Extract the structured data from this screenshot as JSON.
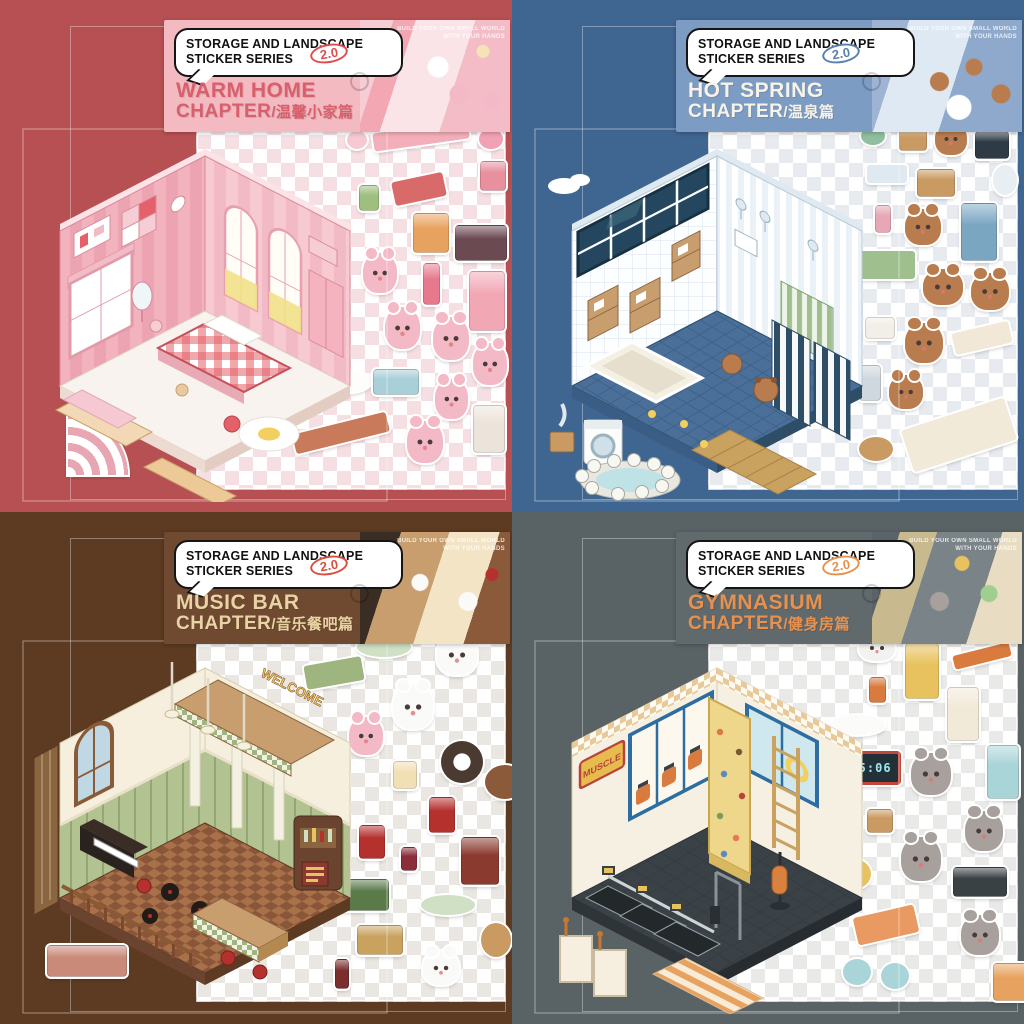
{
  "series": {
    "label_line1": "STORAGE AND LANDSCAPE",
    "label_line2": "STICKER SERIES",
    "version": "2.0",
    "tagline_line1": "BUILD YOUR OWN SMALL WORLD",
    "tagline_line2": "WITH YOUR HANDS"
  },
  "panels": [
    {
      "id": "warm-home",
      "title_line1": "WARM HOME",
      "title_line2": "CHAPTER",
      "title_cn": "/温馨小家篇",
      "colors": {
        "background": "#b75052",
        "header": "#f3bac2",
        "title": "#d95f6c",
        "badge": "#e04b52",
        "wall": "#f2b3bf",
        "floor": "#f8f3ee",
        "character": "#f4b9c6",
        "checker": "#f6dfe3"
      },
      "stickers": [
        {
          "name": "bunting-shelf-sticker",
          "type": "flat",
          "color": "#f2aeb9",
          "x": 176,
          "y": 6,
          "w": 96,
          "h": 18,
          "r": -8
        },
        {
          "name": "pink-donut-sticker",
          "type": "round",
          "color": "#f6c9d2",
          "x": 150,
          "y": 10,
          "w": 20,
          "h": 18
        },
        {
          "name": "heart-cushion-sticker",
          "type": "round",
          "color": "#f2a0b4",
          "x": 282,
          "y": 8,
          "w": 24,
          "h": 20
        },
        {
          "name": "wall-art-sticker",
          "type": "box",
          "color": "#e8909e",
          "x": 283,
          "y": 40,
          "w": 24,
          "h": 28
        },
        {
          "name": "red-desk-sticker",
          "type": "flat",
          "color": "#d96a6a",
          "x": 196,
          "y": 56,
          "w": 52,
          "h": 24,
          "r": -12
        },
        {
          "name": "potted-plant-sticker",
          "type": "box",
          "color": "#9fbf7f",
          "x": 162,
          "y": 64,
          "w": 18,
          "h": 24
        },
        {
          "name": "drawer-unit-sticker",
          "type": "box",
          "color": "#e8a25f",
          "x": 216,
          "y": 92,
          "w": 34,
          "h": 38
        },
        {
          "name": "tv-console-sticker",
          "type": "box",
          "color": "#6b4a52",
          "x": 258,
          "y": 104,
          "w": 50,
          "h": 34
        },
        {
          "name": "bunny-reading-sticker",
          "type": "char",
          "color": "#f4b9c6",
          "x": 166,
          "y": 132,
          "w": 34,
          "h": 40
        },
        {
          "name": "floor-lamp-sticker",
          "type": "tallbox",
          "color": "#e8798c",
          "x": 226,
          "y": 142,
          "w": 15,
          "h": 40
        },
        {
          "name": "pink-fridge-sticker",
          "type": "tallbox",
          "color": "#f2a7b5",
          "x": 272,
          "y": 150,
          "w": 34,
          "h": 58
        },
        {
          "name": "bunny-waving-sticker",
          "type": "char",
          "color": "#f4b9c6",
          "x": 188,
          "y": 186,
          "w": 35,
          "h": 42
        },
        {
          "name": "bunny-bow-sticker",
          "type": "char",
          "color": "#f4b9c6",
          "x": 236,
          "y": 196,
          "w": 36,
          "h": 43
        },
        {
          "name": "white-rug-sticker",
          "type": "oval",
          "color": "#fdfdfb",
          "x": 118,
          "y": 250,
          "w": 56,
          "h": 22
        },
        {
          "name": "bunny-broom-sticker",
          "type": "char",
          "color": "#f4b9c6",
          "x": 276,
          "y": 222,
          "w": 34,
          "h": 42
        },
        {
          "name": "storage-box-sticker",
          "type": "box",
          "color": "#a9cfd8",
          "x": 176,
          "y": 248,
          "w": 44,
          "h": 24
        },
        {
          "name": "bunny-sleepy-sticker",
          "type": "char",
          "color": "#f4b9c6",
          "x": 238,
          "y": 258,
          "w": 33,
          "h": 40
        },
        {
          "name": "fireplace-sticker",
          "type": "box",
          "color": "#ece4da",
          "x": 276,
          "y": 284,
          "w": 30,
          "h": 46
        },
        {
          "name": "brick-bench-sticker",
          "type": "flat",
          "color": "#c97a5a",
          "x": 96,
          "y": 302,
          "w": 96,
          "h": 20,
          "r": -14
        },
        {
          "name": "bunny-cake-sticker",
          "type": "char",
          "color": "#f4b9c6",
          "x": 210,
          "y": 300,
          "w": 36,
          "h": 42
        },
        {
          "name": "rainbow-corner-sticker",
          "type": "fan",
          "color": "#e8a5b2",
          "x": -129,
          "y": 294,
          "w": 60,
          "h": 60
        }
      ]
    },
    {
      "id": "hot-spring",
      "title_line1": "HOT SPRING",
      "title_line2": "CHAPTER",
      "title_cn": "/温泉篇",
      "colors": {
        "background": "#3f6591",
        "header": "#7d9cc4",
        "title": "#f7f3e8",
        "badge": "#5a7fae",
        "wall": "#fdfeff",
        "floor": "#4a7099",
        "character": "#b97c4e",
        "checker": "#e7ebef"
      },
      "stickers": [
        {
          "name": "shower-cap-sticker",
          "type": "round",
          "color": "#8fbf9f",
          "x": 152,
          "y": 6,
          "w": 24,
          "h": 18
        },
        {
          "name": "wooden-bucket-sticker",
          "type": "box",
          "color": "#c99a62",
          "x": 190,
          "y": 8,
          "w": 26,
          "h": 20
        },
        {
          "name": "capybara-towel-sticker",
          "type": "char",
          "color": "#b97c4e",
          "x": 226,
          "y": 2,
          "w": 32,
          "h": 32
        },
        {
          "name": "black-tablet-sticker",
          "type": "box",
          "color": "#2e3a46",
          "x": 266,
          "y": 10,
          "w": 32,
          "h": 26
        },
        {
          "name": "hand-mirror-sticker",
          "type": "round",
          "color": "#e8eef2",
          "x": 284,
          "y": 44,
          "w": 24,
          "h": 30
        },
        {
          "name": "towel-rack-sticker",
          "type": "flat",
          "color": "#dfe9f2",
          "x": 158,
          "y": 44,
          "w": 40,
          "h": 18
        },
        {
          "name": "soap-shelf-sticker",
          "type": "box",
          "color": "#c99a62",
          "x": 208,
          "y": 48,
          "w": 36,
          "h": 26
        },
        {
          "name": "shampoo-bottle-sticker",
          "type": "tallbox",
          "color": "#e8a7b5",
          "x": 166,
          "y": 84,
          "w": 14,
          "h": 26
        },
        {
          "name": "capybara-washing-sticker",
          "type": "char",
          "color": "#b97c4e",
          "x": 196,
          "y": 88,
          "w": 36,
          "h": 36
        },
        {
          "name": "blue-cabinet-sticker",
          "type": "tallbox",
          "color": "#7aa6c2",
          "x": 252,
          "y": 82,
          "w": 34,
          "h": 56
        },
        {
          "name": "bath-fence-sticker",
          "type": "flat",
          "color": "#9fbf8f",
          "x": 150,
          "y": 130,
          "w": 56,
          "h": 28
        },
        {
          "name": "capybara-soaking-sticker",
          "type": "char",
          "color": "#b97c4e",
          "x": 214,
          "y": 148,
          "w": 40,
          "h": 36
        },
        {
          "name": "capybara-duck-sticker",
          "type": "char",
          "color": "#b97c4e",
          "x": 262,
          "y": 152,
          "w": 38,
          "h": 37
        },
        {
          "name": "white-stool-sticker",
          "type": "box",
          "color": "#f2efe8",
          "x": 156,
          "y": 196,
          "w": 28,
          "h": 20
        },
        {
          "name": "capybara-shower-sticker",
          "type": "char",
          "color": "#b97c4e",
          "x": 196,
          "y": 202,
          "w": 38,
          "h": 40
        },
        {
          "name": "cream-bench-sticker",
          "type": "flat",
          "color": "#f2e8d8",
          "x": 244,
          "y": 206,
          "w": 58,
          "h": 22,
          "r": -13
        },
        {
          "name": "stone-lantern-sticker",
          "type": "tallbox",
          "color": "#cfd8df",
          "x": 150,
          "y": 244,
          "w": 20,
          "h": 34
        },
        {
          "name": "capybara-egg-sticker",
          "type": "char",
          "color": "#b97c4e",
          "x": 180,
          "y": 254,
          "w": 34,
          "h": 34
        },
        {
          "name": "tatami-mat-sticker",
          "type": "flat",
          "color": "#f2ead8",
          "x": 196,
          "y": 292,
          "w": 108,
          "h": 44,
          "r": -18
        },
        {
          "name": "wooden-tub-sticker",
          "type": "round",
          "color": "#c99a62",
          "x": 150,
          "y": 316,
          "w": 34,
          "h": 24
        }
      ]
    },
    {
      "id": "music-bar",
      "title_line1": "MUSIC BAR",
      "title_line2": "CHAPTER",
      "title_cn": "/音乐餐吧篇",
      "colors": {
        "background": "#5d3a22",
        "header": "#6f4a31",
        "title": "#e9d3a4",
        "badge": "#d94f3d",
        "wall": "#f6efdd",
        "floor": "#a9714a",
        "character": "#fafaf8",
        "checker": "#eae7e2"
      },
      "scene": {
        "welcome_sign": "WELCOME"
      },
      "stickers": [
        {
          "name": "dotted-platter-sticker",
          "type": "oval",
          "color": "#cfe0c4",
          "x": 160,
          "y": 4,
          "w": 54,
          "h": 20
        },
        {
          "name": "panda-chef-sticker",
          "type": "char",
          "color": "#fafaf8",
          "x": 240,
          "y": 2,
          "w": 40,
          "h": 40
        },
        {
          "name": "green-sofa-sticker",
          "type": "flat",
          "color": "#9fb57f",
          "x": 108,
          "y": 28,
          "w": 58,
          "h": 24,
          "r": -10
        },
        {
          "name": "panda-waiter-sticker",
          "type": "char",
          "color": "#fafaf8",
          "x": 196,
          "y": 52,
          "w": 40,
          "h": 44
        },
        {
          "name": "bunny-guest-sticker",
          "type": "char",
          "color": "#f4b9c6",
          "x": 152,
          "y": 84,
          "w": 34,
          "h": 38
        },
        {
          "name": "wagon-wheel-sticker",
          "type": "ring",
          "color": "#4a3a30",
          "x": 244,
          "y": 108,
          "w": 42,
          "h": 42
        },
        {
          "name": "round-table-sticker",
          "type": "round",
          "color": "#8a5a3a",
          "x": 288,
          "y": 132,
          "w": 40,
          "h": 34
        },
        {
          "name": "beer-mug-sticker",
          "type": "box",
          "color": "#f2e0b5",
          "x": 196,
          "y": 128,
          "w": 22,
          "h": 26
        },
        {
          "name": "bar-stool-sticker",
          "type": "tallbox",
          "color": "#b5312e",
          "x": 232,
          "y": 164,
          "w": 24,
          "h": 34
        },
        {
          "name": "menu-board-sticker",
          "type": "box",
          "color": "#8a3a2e",
          "x": 264,
          "y": 204,
          "w": 36,
          "h": 46
        },
        {
          "name": "wine-glass-sticker",
          "type": "tallbox",
          "color": "#8a2e3a",
          "x": 204,
          "y": 214,
          "w": 14,
          "h": 22
        },
        {
          "name": "red-stool-sticker",
          "type": "tallbox",
          "color": "#b5312e",
          "x": 162,
          "y": 192,
          "w": 24,
          "h": 32
        },
        {
          "name": "bottle-crate-sticker",
          "type": "box",
          "color": "#5a7a4a",
          "x": 140,
          "y": 246,
          "w": 50,
          "h": 30
        },
        {
          "name": "checker-platter-sticker",
          "type": "oval",
          "color": "#cfe0c4",
          "x": 224,
          "y": 262,
          "w": 54,
          "h": 20
        },
        {
          "name": "wooden-barrel-sticker",
          "type": "round",
          "color": "#c99a62",
          "x": 284,
          "y": 290,
          "w": 30,
          "h": 34
        },
        {
          "name": "beer-crate-sticker",
          "type": "box",
          "color": "#c9a25f",
          "x": 160,
          "y": 292,
          "w": 44,
          "h": 28
        },
        {
          "name": "wine-bottle-sticker",
          "type": "tallbox",
          "color": "#7a2e2e",
          "x": 138,
          "y": 326,
          "w": 12,
          "h": 28
        },
        {
          "name": "panda-cheers-sticker",
          "type": "char",
          "color": "#fafaf8",
          "x": 226,
          "y": 318,
          "w": 36,
          "h": 34
        },
        {
          "name": "flower-planter-sticker",
          "type": "box",
          "color": "#c98a7a",
          "x": -150,
          "y": 312,
          "w": 78,
          "h": 30
        }
      ]
    },
    {
      "id": "gymnasium",
      "title_line1": "GYMNASIUM",
      "title_line2": "CHAPTER",
      "title_cn": "/健身房篇",
      "colors": {
        "background": "#596265",
        "header": "#60696c",
        "title": "#e8914e",
        "badge": "#e8914e",
        "wall": "#f6f0e2",
        "floor": "#3b4247",
        "character": "#a8a09c",
        "checker": "#e9e9e7"
      },
      "scene": {
        "muscle_sign": "MUSCLE",
        "timer_display": "35:06"
      },
      "stickers": [
        {
          "name": "white-cat-sticker",
          "type": "char",
          "color": "#f2f2f0",
          "x": 150,
          "y": 2,
          "w": 36,
          "h": 26
        },
        {
          "name": "yellow-locker-sticker",
          "type": "tallbox",
          "color": "#e8c25f",
          "x": 196,
          "y": 10,
          "w": 32,
          "h": 54
        },
        {
          "name": "orange-shelf-sticker",
          "type": "flat",
          "color": "#d97b3f",
          "x": 244,
          "y": 16,
          "w": 58,
          "h": 14,
          "r": -14
        },
        {
          "name": "protein-shake-sticker",
          "type": "tallbox",
          "color": "#d97b3f",
          "x": 160,
          "y": 44,
          "w": 15,
          "h": 24
        },
        {
          "name": "cream-locker-sticker",
          "type": "tallbox",
          "color": "#f2ead8",
          "x": 238,
          "y": 54,
          "w": 30,
          "h": 52
        },
        {
          "name": "white-tray-sticker",
          "type": "oval",
          "color": "#fbfbf9",
          "x": 122,
          "y": 82,
          "w": 54,
          "h": 20
        },
        {
          "name": "blue-locker-sticker",
          "type": "tallbox",
          "color": "#a9d4d8",
          "x": 278,
          "y": 112,
          "w": 30,
          "h": 52
        },
        {
          "name": "interval-timer-sticker",
          "type": "clock",
          "color": "#c4443a",
          "label": "35:06",
          "x": 132,
          "y": 118,
          "w": 54,
          "h": 28
        },
        {
          "name": "gray-cat-sitting-sticker",
          "type": "char",
          "color": "#a8a09c",
          "x": 202,
          "y": 120,
          "w": 40,
          "h": 42
        },
        {
          "name": "tilt-mirror-sticker",
          "type": "arch",
          "color": "#e8eef2",
          "x": 118,
          "y": 162,
          "w": 28,
          "h": 50
        },
        {
          "name": "photo-frame-sticker",
          "type": "box",
          "color": "#c99a62",
          "x": 158,
          "y": 176,
          "w": 24,
          "h": 22
        },
        {
          "name": "gray-cat-ball-sticker",
          "type": "char",
          "color": "#a8a09c",
          "x": 256,
          "y": 178,
          "w": 38,
          "h": 40
        },
        {
          "name": "yellow-ball-sticker",
          "type": "round",
          "color": "#e8c25f",
          "x": 128,
          "y": 226,
          "w": 34,
          "h": 30
        },
        {
          "name": "gray-cat-wave-sticker",
          "type": "char",
          "color": "#a8a09c",
          "x": 192,
          "y": 204,
          "w": 40,
          "h": 44
        },
        {
          "name": "dumbbell-rack-sticker",
          "type": "box",
          "color": "#3a4144",
          "x": 244,
          "y": 234,
          "w": 52,
          "h": 28
        },
        {
          "name": "bench-press-sticker",
          "type": "flat",
          "color": "#e89a62",
          "x": 146,
          "y": 278,
          "w": 62,
          "h": 28,
          "r": -13
        },
        {
          "name": "gray-cat-run-sticker",
          "type": "char",
          "color": "#a8a09c",
          "x": 252,
          "y": 282,
          "w": 38,
          "h": 40
        },
        {
          "name": "kettlebell-sticker",
          "type": "round",
          "color": "#a9d4d8",
          "x": 134,
          "y": 326,
          "w": 28,
          "h": 26
        },
        {
          "name": "kettlebell-2-sticker",
          "type": "round",
          "color": "#a9d4d8",
          "x": 172,
          "y": 330,
          "w": 28,
          "h": 26
        },
        {
          "name": "shoe-locker-sticker",
          "type": "box",
          "color": "#e8a25f",
          "x": 284,
          "y": 330,
          "w": 40,
          "h": 36
        }
      ]
    }
  ]
}
